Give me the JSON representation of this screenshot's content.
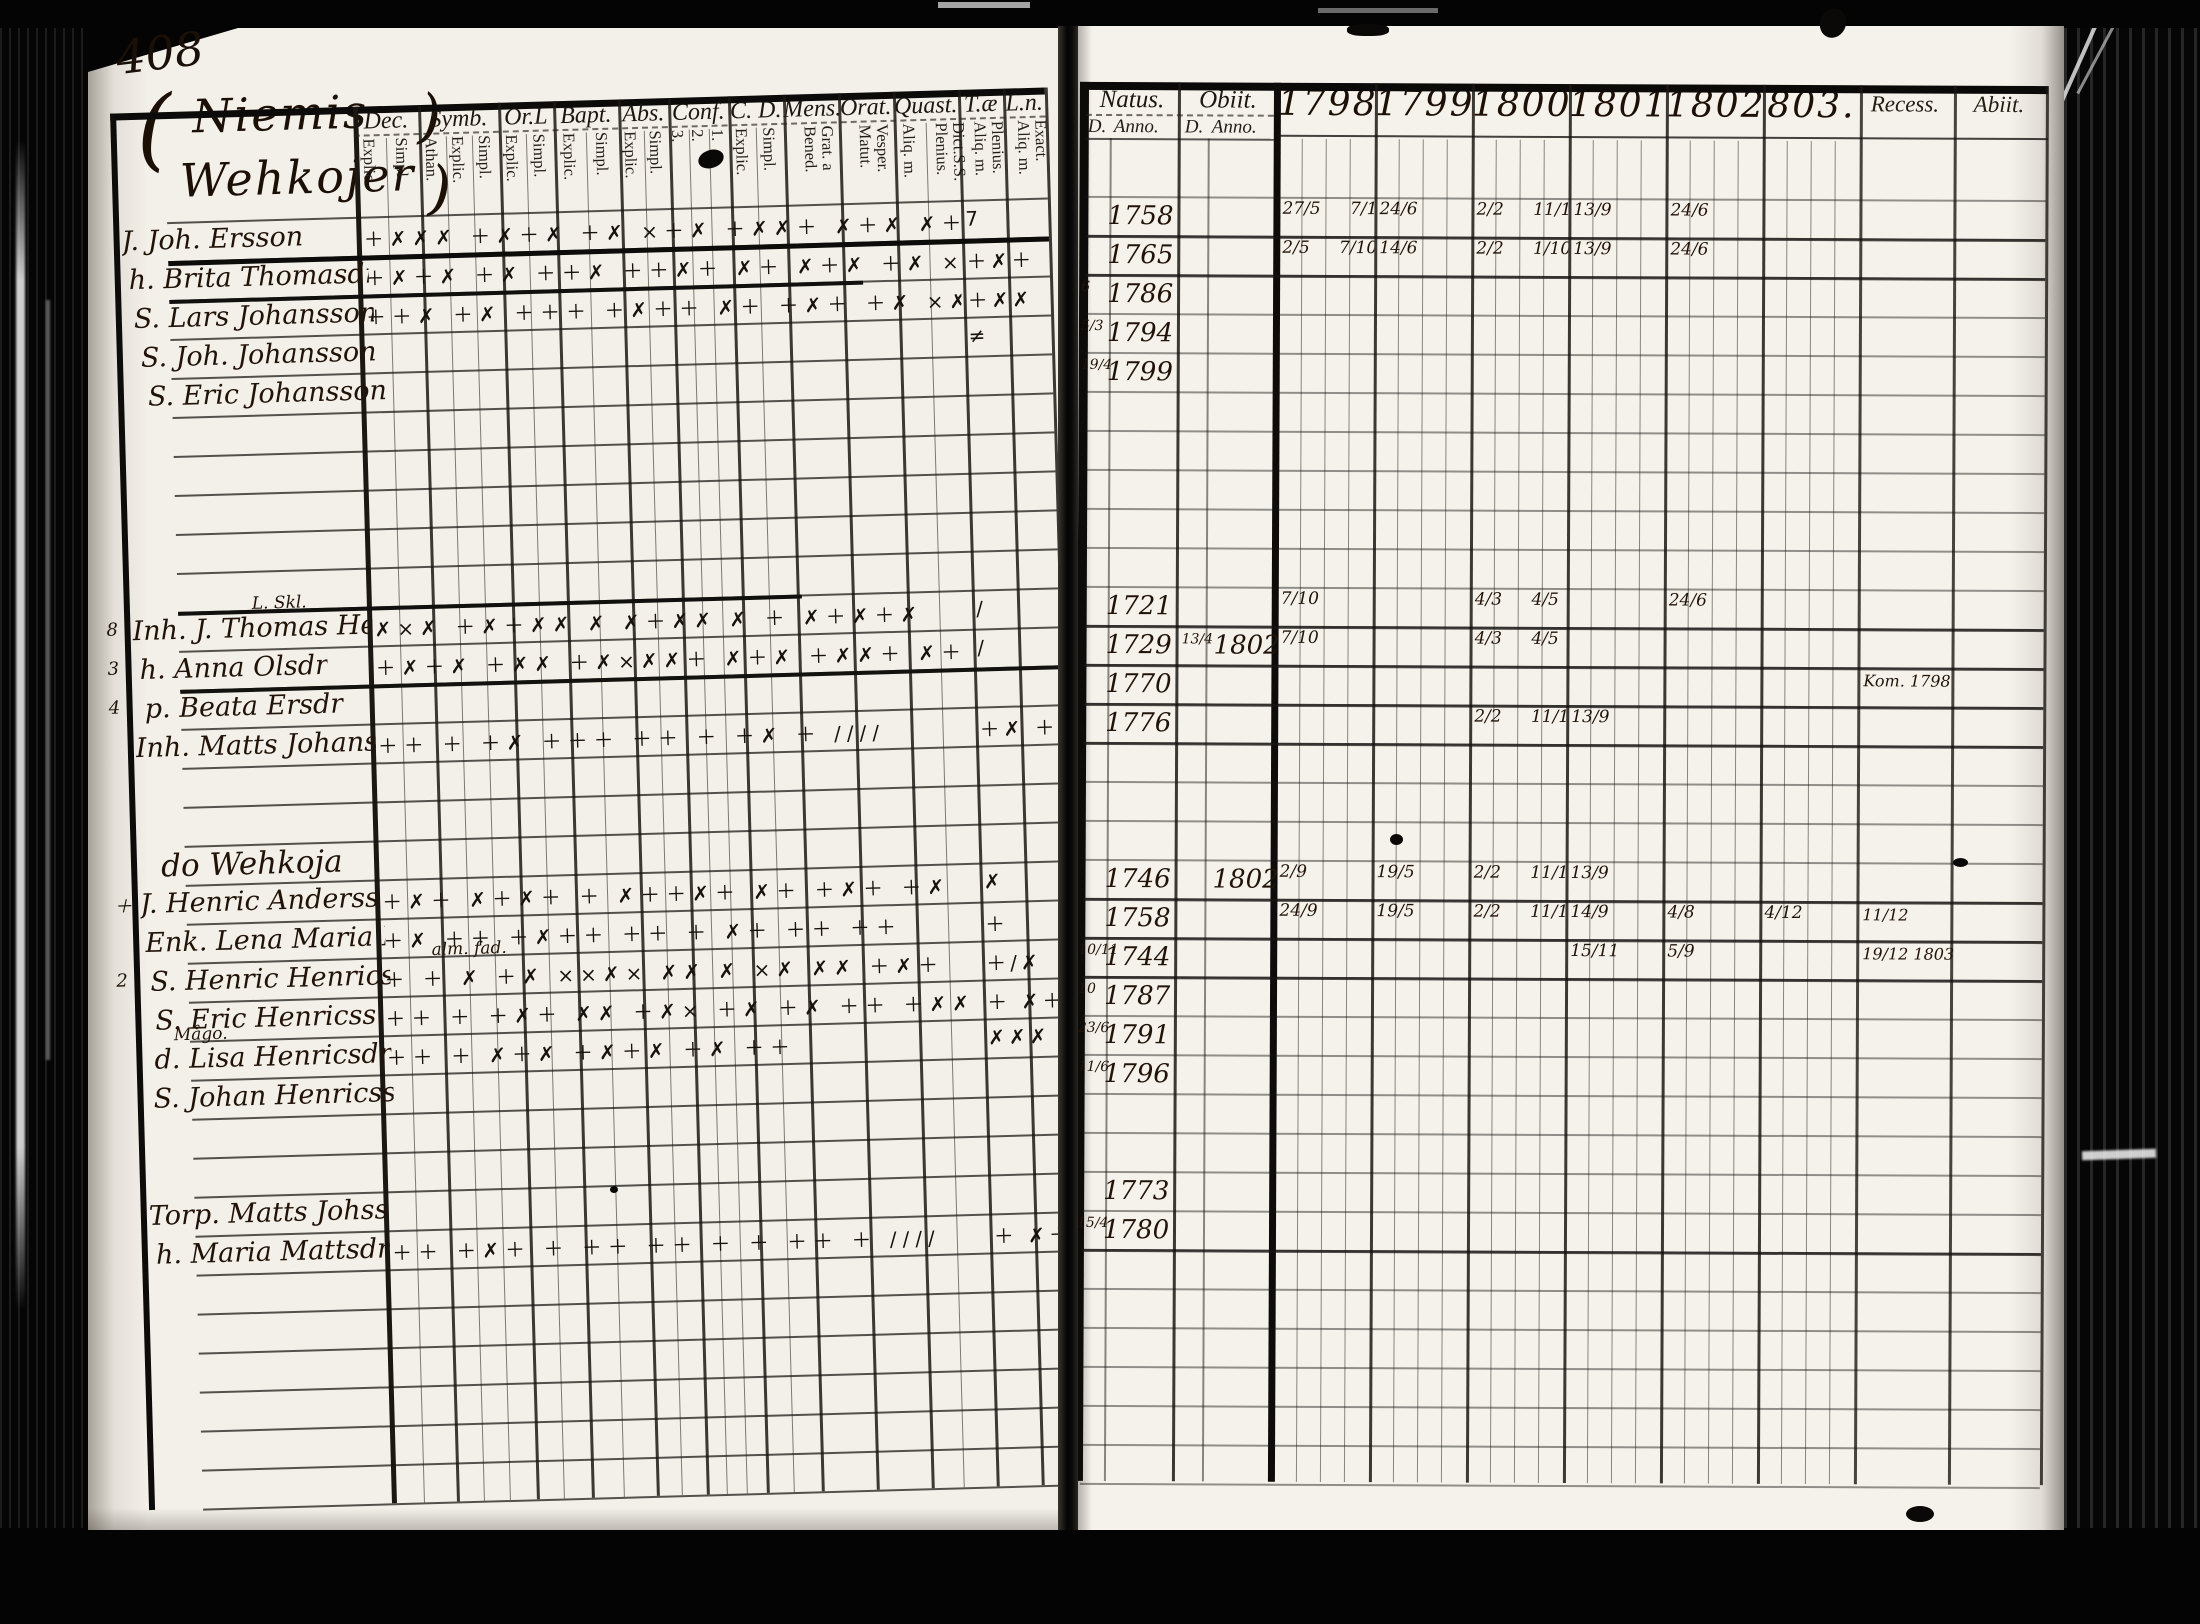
{
  "page_number": "408",
  "left_page": {
    "heading_lines": [
      "Niemis",
      "Wehkojer"
    ],
    "heading_brace": "(",
    "heading_close": ")",
    "columns": [
      {
        "id": "dec",
        "label": "Dec.",
        "subs": [
          "Explic.",
          "Simpl."
        ]
      },
      {
        "id": "symb",
        "label": "Symb.",
        "subs": [
          "Athan.",
          "Explic.",
          "Simpl."
        ]
      },
      {
        "id": "orl",
        "label": "Or.L",
        "subs": [
          "Explic.",
          "Simpl."
        ]
      },
      {
        "id": "bapt",
        "label": "Bapt.",
        "subs": [
          "Explic.",
          "Simpl."
        ]
      },
      {
        "id": "abs",
        "label": "Abs.",
        "subs": [
          "Explic.",
          "Simpl."
        ]
      },
      {
        "id": "conf",
        "label": "Conf.",
        "subs": [
          "3.",
          "2.",
          "1."
        ]
      },
      {
        "id": "cd",
        "label": "C. D.",
        "subs": [
          "Explic.",
          "Simpl."
        ]
      },
      {
        "id": "mens",
        "label": "Mens.",
        "subs": [
          "Grat. a Bened."
        ]
      },
      {
        "id": "orat",
        "label": "Orat.",
        "subs": [
          "Vesper. Matut."
        ]
      },
      {
        "id": "quast",
        "label": "Quast.",
        "subs": [
          "Aliq. m.",
          "Dict.S.S. Plenius."
        ]
      },
      {
        "id": "tae",
        "label": "T.æ",
        "subs": [
          "Plenius. Aliq. m."
        ]
      },
      {
        "id": "ln",
        "label": "L.n.",
        "subs": [
          "Exact. Aliq. m."
        ]
      }
    ],
    "entries": [
      {
        "row": 0,
        "name": "J. Joh. Ersson",
        "marks": "＋✗✗✗ ＋✗＋✗ ＋✗ ×＋✗ ＋✗✗＋ ✗＋✗ ✗＋✗✗",
        "tail": "7"
      },
      {
        "row": 1,
        "name": "h. Brita Thomasdr",
        "indent": 6,
        "marks": "＋✗＋✗ ＋✗ ＋＋✗ ＋＋✗＋ ✗＋ ✗＋✗ ＋✗ ×✗",
        "tail": "＋✗＋"
      },
      {
        "row": 2,
        "name": "S. Lars Johansson",
        "indent": 10,
        "marks": "＋＋✗ ＋✗ ＋＋＋ ＋✗＋＋ ✗＋ ＋✗＋ ＋✗ ×✗",
        "tail": "＋✗✗"
      },
      {
        "row": 3,
        "name": "S. Joh. Johansson",
        "indent": 16,
        "marks": "",
        "tail": "≠"
      },
      {
        "row": 4,
        "name": "S. Eric Johansson",
        "indent": 22,
        "marks": "",
        "tail": ""
      },
      {
        "row": 10,
        "name": "Inh. J. Thomas Henricss.",
        "margin": "8",
        "ann": "L. Skl.",
        "ann_x": 150,
        "marks": "✗×✗ ＋✗＋✗✗ ✗ ✗＋✗✗ ✗ ＋ ✗＋✗＋✗",
        "tail": "∕"
      },
      {
        "row": 11,
        "name": "h. Anna Olsdr",
        "margin": "3",
        "indent": 6,
        "marks": "＋✗＋✗ ＋✗✗ ＋✗×✗✗＋ ✗＋✗ ＋✗✗＋ ✗＋",
        "tail": "∕"
      },
      {
        "row": 12,
        "name": "p. Beata Ersdr",
        "margin": "4",
        "indent": 10,
        "marks": "",
        "tail": ""
      },
      {
        "row": 13,
        "name": "Inh. Matts Johansson",
        "marks": "＋＋ ＋ ＋✗ ＋＋＋ ＋＋ ＋ ＋✗ ＋ ∕∕∕∕",
        "tail": "＋✗ ＋"
      },
      {
        "row": 16,
        "place": "do Wehkoja"
      },
      {
        "row": 17,
        "name": "J. Henric Anderss.",
        "margin": "＋",
        "marks": "＋✗＋ ✗＋✗＋ ＋ ✗＋＋✗＋ ✗＋ ＋✗＋ ＋✗",
        "tail": "✗"
      },
      {
        "row": 18,
        "name": "Enk. Lena Maria Michelsdr",
        "indent": 4,
        "marks": "＋✗ ＋＋ ＋✗＋＋ ＋＋ ＋ ✗＋ ＋＋ ＋＋",
        "tail": "＋"
      },
      {
        "row": 19,
        "name": "S. Henric Henricss.",
        "margin": "2",
        "ann": "alm. fad.",
        "ann_x": 320,
        "indent": 8,
        "marks": "＋ ＋ ✗ ＋✗ ××✗× ✗✗ ✗ ×✗ ✗✗ ＋✗＋",
        "tail": "＋∕✗"
      },
      {
        "row": 20,
        "name": "S. Eric Henricss.",
        "indent": 12,
        "marks": "＋＋ ＋ ＋✗＋ ✗✗ ＋✗× ＋✗ ＋✗ ＋＋ ＋✗✗",
        "tail": "＋ ✗＋"
      },
      {
        "row": 21,
        "name": "d. Lisa Henricsdr",
        "ann": "Mågo.",
        "ann_x": 60,
        "indent": 10,
        "marks": "＋＋ ＋ ✗＋✗ ＋✗＋✗ ＋✗ ＋＋",
        "tail": "✗✗✗"
      },
      {
        "row": 22,
        "name": "S. Johan Henricss.",
        "indent": 8,
        "marks": "",
        "tail": ""
      },
      {
        "row": 25,
        "name": "Torp. Matts Johss.",
        "marks": "",
        "tail": ""
      },
      {
        "row": 26,
        "name": "h. Maria Mattsdr",
        "indent": 6,
        "marks": "＋＋ ＋✗＋ ＋ ＋＋ ＋＋ ＋ ＋ ＋＋ ＋ ∕∕∕∕",
        "tail": "＋ ✗＋"
      }
    ]
  },
  "right_page": {
    "natus_label": "Natus.",
    "obiit_label": "Obiit.",
    "d_anno": [
      "D.",
      "Anno."
    ],
    "years": [
      "1798",
      "1799",
      "1800",
      "1801",
      "1802",
      "803."
    ],
    "end_labels": [
      "Recess.",
      "Abiit."
    ],
    "entries": [
      {
        "row": 0,
        "natus": "1758",
        "year_values": [
          "27/5 7/10",
          "24/6",
          "2/2 11/10",
          "13/9",
          "24/6",
          ""
        ]
      },
      {
        "row": 1,
        "natus": "1765",
        "year_values": [
          "2/5 7/10",
          "14/6",
          "2/2 1/10",
          "13/9",
          "24/6",
          ""
        ]
      },
      {
        "row": 2,
        "natus_pre": "6",
        "natus": "1786"
      },
      {
        "row": 3,
        "natus_pre": "5/3",
        "natus": "1794"
      },
      {
        "row": 4,
        "natus_pre": "19/4",
        "natus": "1799"
      },
      {
        "row": 10,
        "natus": "1721",
        "year_values": [
          "7/10",
          "",
          "4/3 4/5",
          "",
          "24/6",
          ""
        ]
      },
      {
        "row": 11,
        "natus": "1729",
        "obiit_pre": "13/4",
        "obiit": "1802",
        "year_values": [
          "7/10",
          "",
          "4/3 4/5",
          "",
          "",
          ""
        ]
      },
      {
        "row": 12,
        "natus": "1770",
        "end_note": "Kom. 1798"
      },
      {
        "row": 13,
        "natus": "1776",
        "year_values": [
          "",
          "",
          "2/2 11/10",
          "13/9",
          "",
          ""
        ]
      },
      {
        "row": 17,
        "natus": "1746",
        "obiit": "1802",
        "year_values": [
          "2/9",
          "19/5",
          "2/2 11/10",
          "13/9",
          "",
          ""
        ]
      },
      {
        "row": 18,
        "natus": "1758",
        "year_values": [
          "24/9",
          "19/5",
          "2/2 11/10",
          "14/9",
          "4/8",
          "4/12"
        ],
        "end_note": "11/12"
      },
      {
        "row": 19,
        "natus_pre": "10/11",
        "natus": "1744",
        "year_values": [
          "",
          "",
          "",
          "15/11",
          "5/9",
          ""
        ],
        "end_note": "19/12 1803"
      },
      {
        "row": 20,
        "natus_pre": "10",
        "natus": "1787"
      },
      {
        "row": 21,
        "natus_pre": "23/6",
        "natus": "1791"
      },
      {
        "row": 22,
        "natus_pre": "11/6",
        "natus": "1796"
      },
      {
        "row": 25,
        "natus": "1773"
      },
      {
        "row": 26,
        "natus_pre": "15/4",
        "natus": "1780"
      }
    ]
  }
}
